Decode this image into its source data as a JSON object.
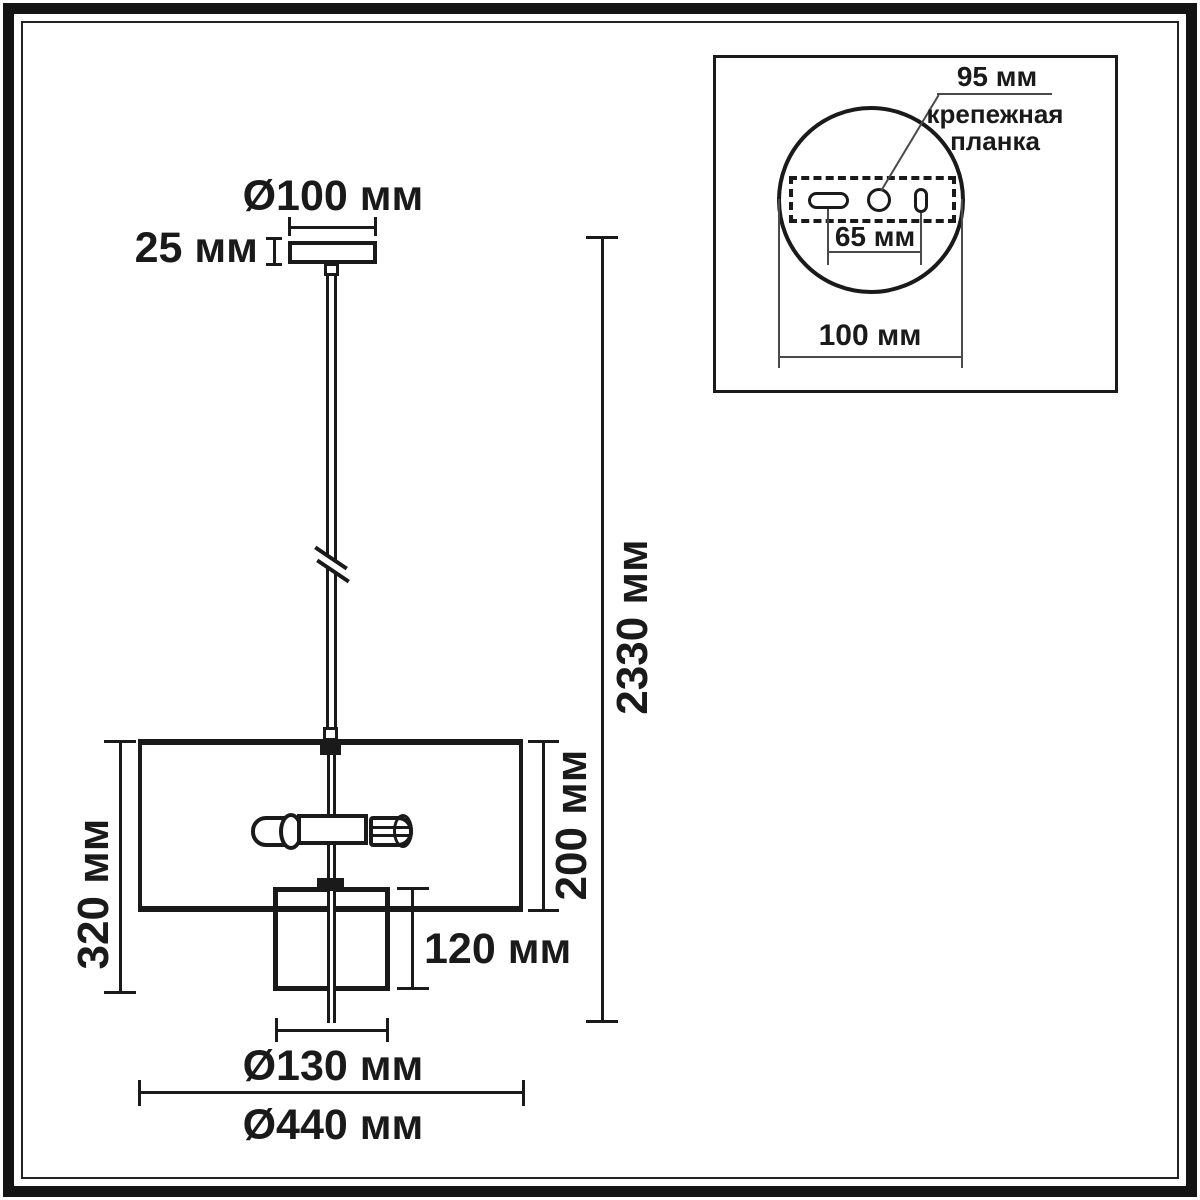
{
  "colors": {
    "line": "#1a1a1a",
    "thin_line": "#4a4a4a",
    "background": "#ffffff"
  },
  "main_drawing": {
    "labels": {
      "canopy_diameter": "Ø100 мм",
      "canopy_height": "25 мм",
      "total_height": "2330 мм",
      "fixture_height": "320 мм",
      "shade_height": "200 мм",
      "inner_shade_height": "120 мм",
      "inner_shade_diameter": "Ø130 мм",
      "shade_diameter": "Ø440 мм"
    }
  },
  "inset": {
    "labels": {
      "plate_length": "95 мм",
      "plate_caption_line1": "крепежная",
      "plate_caption_line2": "планка",
      "hole_spacing": "65 мм",
      "base_diameter": "100 мм"
    }
  }
}
